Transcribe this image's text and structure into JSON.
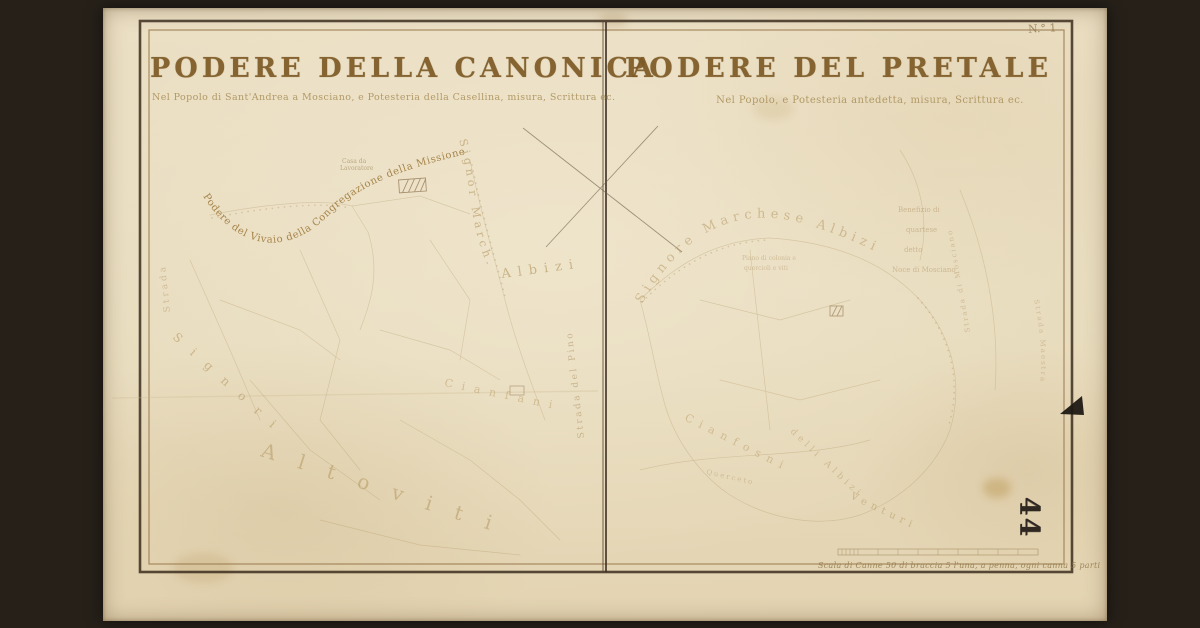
{
  "photo": {
    "background_color": "#262019",
    "parchment_color": "#e9dcc0"
  },
  "sheet": {
    "sheet_number": "N.° 1",
    "archive_stamp": "44",
    "scale_caption": "Scala di Canne 50 di braccia 5 l'una, a penna, ogni canna 5 parti",
    "ink_colors": {
      "title": "#7d5a26",
      "subtitle": "#a98e57",
      "label_strong": "#9a7434",
      "label_faint": "#b1935a",
      "frame": "#3c2e1f"
    },
    "left_map": {
      "title": "PODERE DELLA CANONICA",
      "subtitle": "Nel Popolo di Sant'Andrea a Mosciano, e Potesteria della Casellina, misura, Scrittura ec.",
      "labels": {
        "neighbor_north": "Podere del Vivaio della Congregazione della Missione",
        "neighbor_east_1": "Signor March.",
        "neighbor_east_2": "Albizi",
        "neighbor_west_1": "Signori",
        "neighbor_west_2": "Altoviti",
        "neighbor_south": "Cianfani",
        "road_center": "Strada del Pino",
        "road_west": "Strada",
        "house_caption_1": "Casa da",
        "house_caption_2": "Lavoratore"
      }
    },
    "right_map": {
      "title": "PODERE DEL PRETALE",
      "subtitle": "Nel Popolo, e Potesteria antedetta, misura, Scrittura ec.",
      "labels": {
        "neighbor_north": "Signore Marchese Albizi",
        "benefice_1": "Benefizio di",
        "benefice_2": "quartese",
        "benefice_3": "detto",
        "benefice_4": "Noce di Mosciano",
        "field_note_1": "Piano di colonia e",
        "field_note_2": "quercioli e viti",
        "neighbor_south_1": "Cianfosni",
        "neighbor_south_2": "delli Albizi",
        "neighbor_south_3": "Venturi",
        "road_east_1": "Strada di Mosciano",
        "road_east_2": "Strada Maestra",
        "field_small": "Querceto"
      }
    }
  }
}
